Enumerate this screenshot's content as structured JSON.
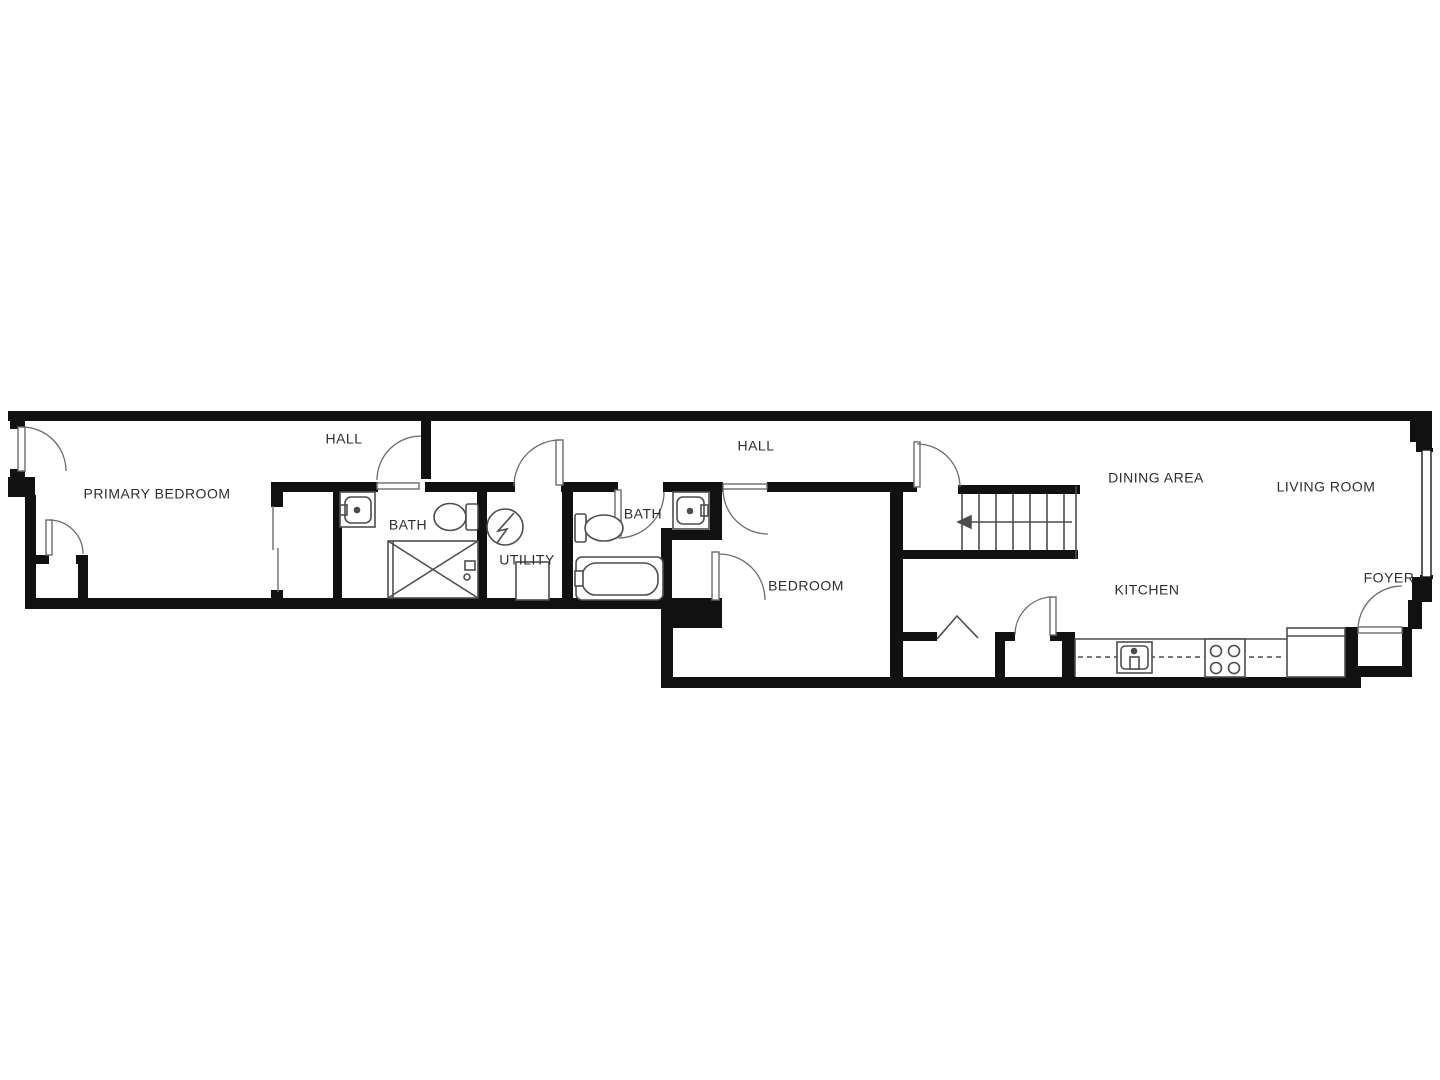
{
  "title": "Apartment floor plan",
  "colors": {
    "wall": "#111111",
    "fixture": "#4d4d4d",
    "door": "#6b6b6b",
    "label": "#2e2e2e",
    "background": "#ffffff"
  },
  "rooms": {
    "primary_bedroom": {
      "label": "PRIMARY BEDROOM"
    },
    "hall_west": {
      "label": "HALL"
    },
    "bath_west": {
      "label": "BATH"
    },
    "utility": {
      "label": "UTILITY"
    },
    "hall_east": {
      "label": "HALL"
    },
    "bath_east": {
      "label": "BATH"
    },
    "bedroom": {
      "label": "BEDROOM"
    },
    "dining_area": {
      "label": "DINING AREA"
    },
    "living_room": {
      "label": "LIVING ROOM"
    },
    "kitchen": {
      "label": "KITCHEN"
    },
    "foyer": {
      "label": "FOYER"
    }
  },
  "stairs": {
    "treads": 7,
    "arrow_direction": "left"
  },
  "fixture_symbols": [
    "entry-door",
    "closet-door",
    "sliding-wardrobe-door",
    "bath-sink",
    "toilet",
    "shower",
    "shower-valve",
    "water-heater",
    "washer",
    "bathtub",
    "stairs",
    "under-stair-chevron",
    "kitchen-counter",
    "kitchen-sink",
    "cooktop",
    "peninsula-counter",
    "window",
    "foyer-entry-door"
  ]
}
